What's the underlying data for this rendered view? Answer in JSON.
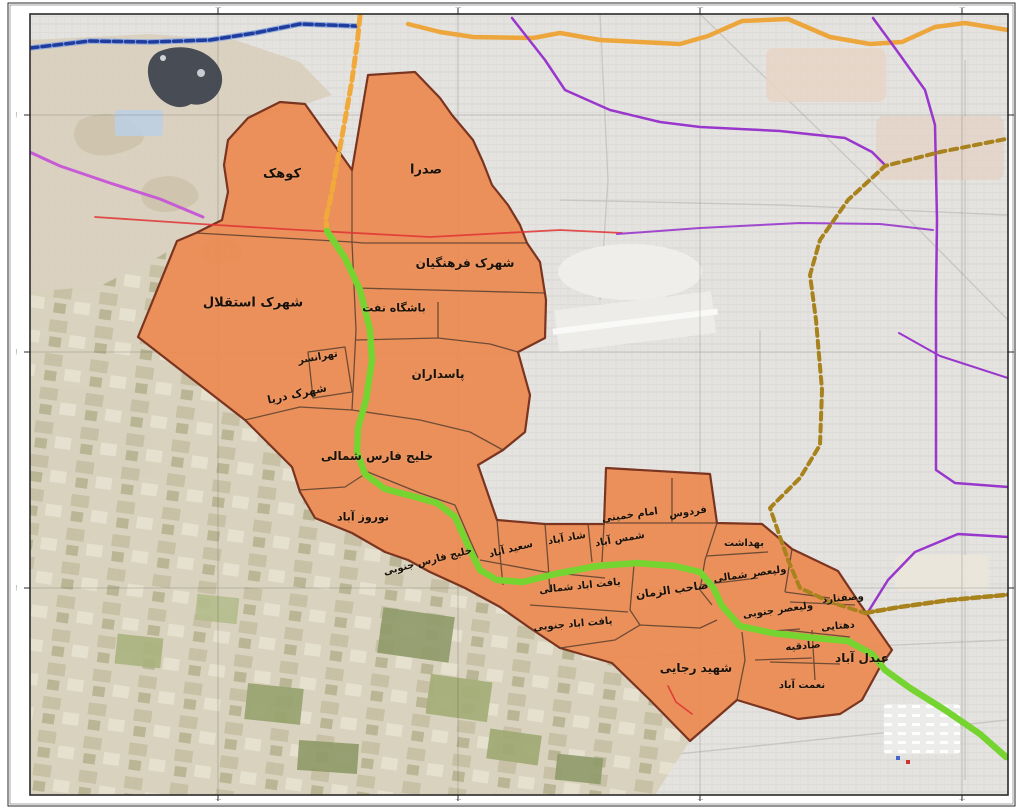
{
  "map": {
    "description_labels_language": "fa",
    "district_labels": [
      {
        "id": "kuhak",
        "label": "کوهک",
        "x": 282,
        "y": 174,
        "rot": 0,
        "size": 13
      },
      {
        "id": "sadra",
        "label": "صدرا",
        "x": 426,
        "y": 170,
        "rot": 0,
        "size": 13
      },
      {
        "id": "shahrak-farhangian",
        "label": "شهرک فرهنگیان",
        "x": 465,
        "y": 263,
        "rot": 0,
        "size": 12
      },
      {
        "id": "shahrak-esteghlal",
        "label": "شهرک استقلال",
        "x": 253,
        "y": 303,
        "rot": 0,
        "size": 13
      },
      {
        "id": "bashgah-naft",
        "label": "باشگاه نفت",
        "x": 394,
        "y": 308,
        "rot": 0,
        "size": 11
      },
      {
        "id": "tehransar",
        "label": "تهرانسر",
        "x": 318,
        "y": 358,
        "rot": -10,
        "size": 10
      },
      {
        "id": "pasdaran",
        "label": "پاسداران",
        "x": 438,
        "y": 374,
        "rot": 0,
        "size": 12
      },
      {
        "id": "shahrak-darya",
        "label": "شهرک دریا",
        "x": 297,
        "y": 394,
        "rot": -12,
        "size": 11
      },
      {
        "id": "khalij-fars-shomali",
        "label": "خلیج فارس شمالی",
        "x": 377,
        "y": 456,
        "rot": 0,
        "size": 12
      },
      {
        "id": "nowruz-abad",
        "label": "نوروز آباد",
        "x": 363,
        "y": 517,
        "rot": 0,
        "size": 11
      },
      {
        "id": "khalij-fars-jonubi",
        "label": "خلیج فارس جنوبی",
        "x": 428,
        "y": 562,
        "rot": -14,
        "size": 10
      },
      {
        "id": "saeed-abad",
        "label": "سعید آباد",
        "x": 511,
        "y": 550,
        "rot": -14,
        "size": 10
      },
      {
        "id": "shad-abad",
        "label": "شاد آباد",
        "x": 567,
        "y": 539,
        "rot": -10,
        "size": 10
      },
      {
        "id": "shams-abad",
        "label": "شمس آباد",
        "x": 620,
        "y": 540,
        "rot": -10,
        "size": 10
      },
      {
        "id": "imam-khomeini",
        "label": "امام خمینی",
        "x": 630,
        "y": 516,
        "rot": -8,
        "size": 10
      },
      {
        "id": "ferdows",
        "label": "فردوس",
        "x": 688,
        "y": 513,
        "rot": -8,
        "size": 10
      },
      {
        "id": "behdasht",
        "label": "بهداشت",
        "x": 744,
        "y": 544,
        "rot": 0,
        "size": 10
      },
      {
        "id": "valiasr-shomali",
        "label": "ولیعصر شمالی",
        "x": 750,
        "y": 575,
        "rot": -8,
        "size": 10
      },
      {
        "id": "valiasr-jonubi",
        "label": "ولیعصر جنوبی",
        "x": 778,
        "y": 611,
        "rot": -8,
        "size": 10
      },
      {
        "id": "vesfenard",
        "label": "وصفنارد",
        "x": 843,
        "y": 599,
        "rot": -5,
        "size": 10
      },
      {
        "id": "dehtayi",
        "label": "دهتایی",
        "x": 838,
        "y": 627,
        "rot": -5,
        "size": 10
      },
      {
        "id": "sadeghieh",
        "label": "صادقیه",
        "x": 803,
        "y": 647,
        "rot": -5,
        "size": 10
      },
      {
        "id": "abdol-abad",
        "label": "عبدل آباد",
        "x": 862,
        "y": 658,
        "rot": 0,
        "size": 12
      },
      {
        "id": "nemat-abad",
        "label": "نعمت آباد",
        "x": 802,
        "y": 686,
        "rot": 0,
        "size": 10
      },
      {
        "id": "yaft-abad-shomali",
        "label": "یافت اباد شمالی",
        "x": 580,
        "y": 587,
        "rot": -6,
        "size": 10
      },
      {
        "id": "yaft-abad-jonubi",
        "label": "یافت اباد جنوبی",
        "x": 573,
        "y": 625,
        "rot": -5,
        "size": 10
      },
      {
        "id": "saheb-azzaman",
        "label": "صاحب الزمان",
        "x": 672,
        "y": 590,
        "rot": -8,
        "size": 11
      },
      {
        "id": "shahid-rajaei",
        "label": "شهید رجایی",
        "x": 696,
        "y": 668,
        "rot": 0,
        "size": 12
      }
    ],
    "frame": {
      "tick_label": "·····",
      "top_ticks_x": [
        218,
        458,
        700,
        962
      ],
      "bottom_ticks_x": [
        218,
        458,
        700,
        962
      ],
      "left_ticks_y": [
        115,
        352,
        588
      ],
      "right_ticks_y": [
        115,
        352,
        588
      ]
    },
    "colors": {
      "district_fill": "#EC8A50",
      "district_border": "#7A341F",
      "inner_border": "#5A4030",
      "green_route": "#76D431",
      "yellow_route": "#F2A93B",
      "orange_route": "#EDA63C",
      "blue_route": "#1F3D9E",
      "blue_route_halo": "#93A9D9",
      "purple_route": "#9937CC",
      "magenta_route": "#C75BD6",
      "red_line": "#E03434",
      "gold_dashed_route": "#A8821C",
      "lake": "#474C55"
    }
  }
}
